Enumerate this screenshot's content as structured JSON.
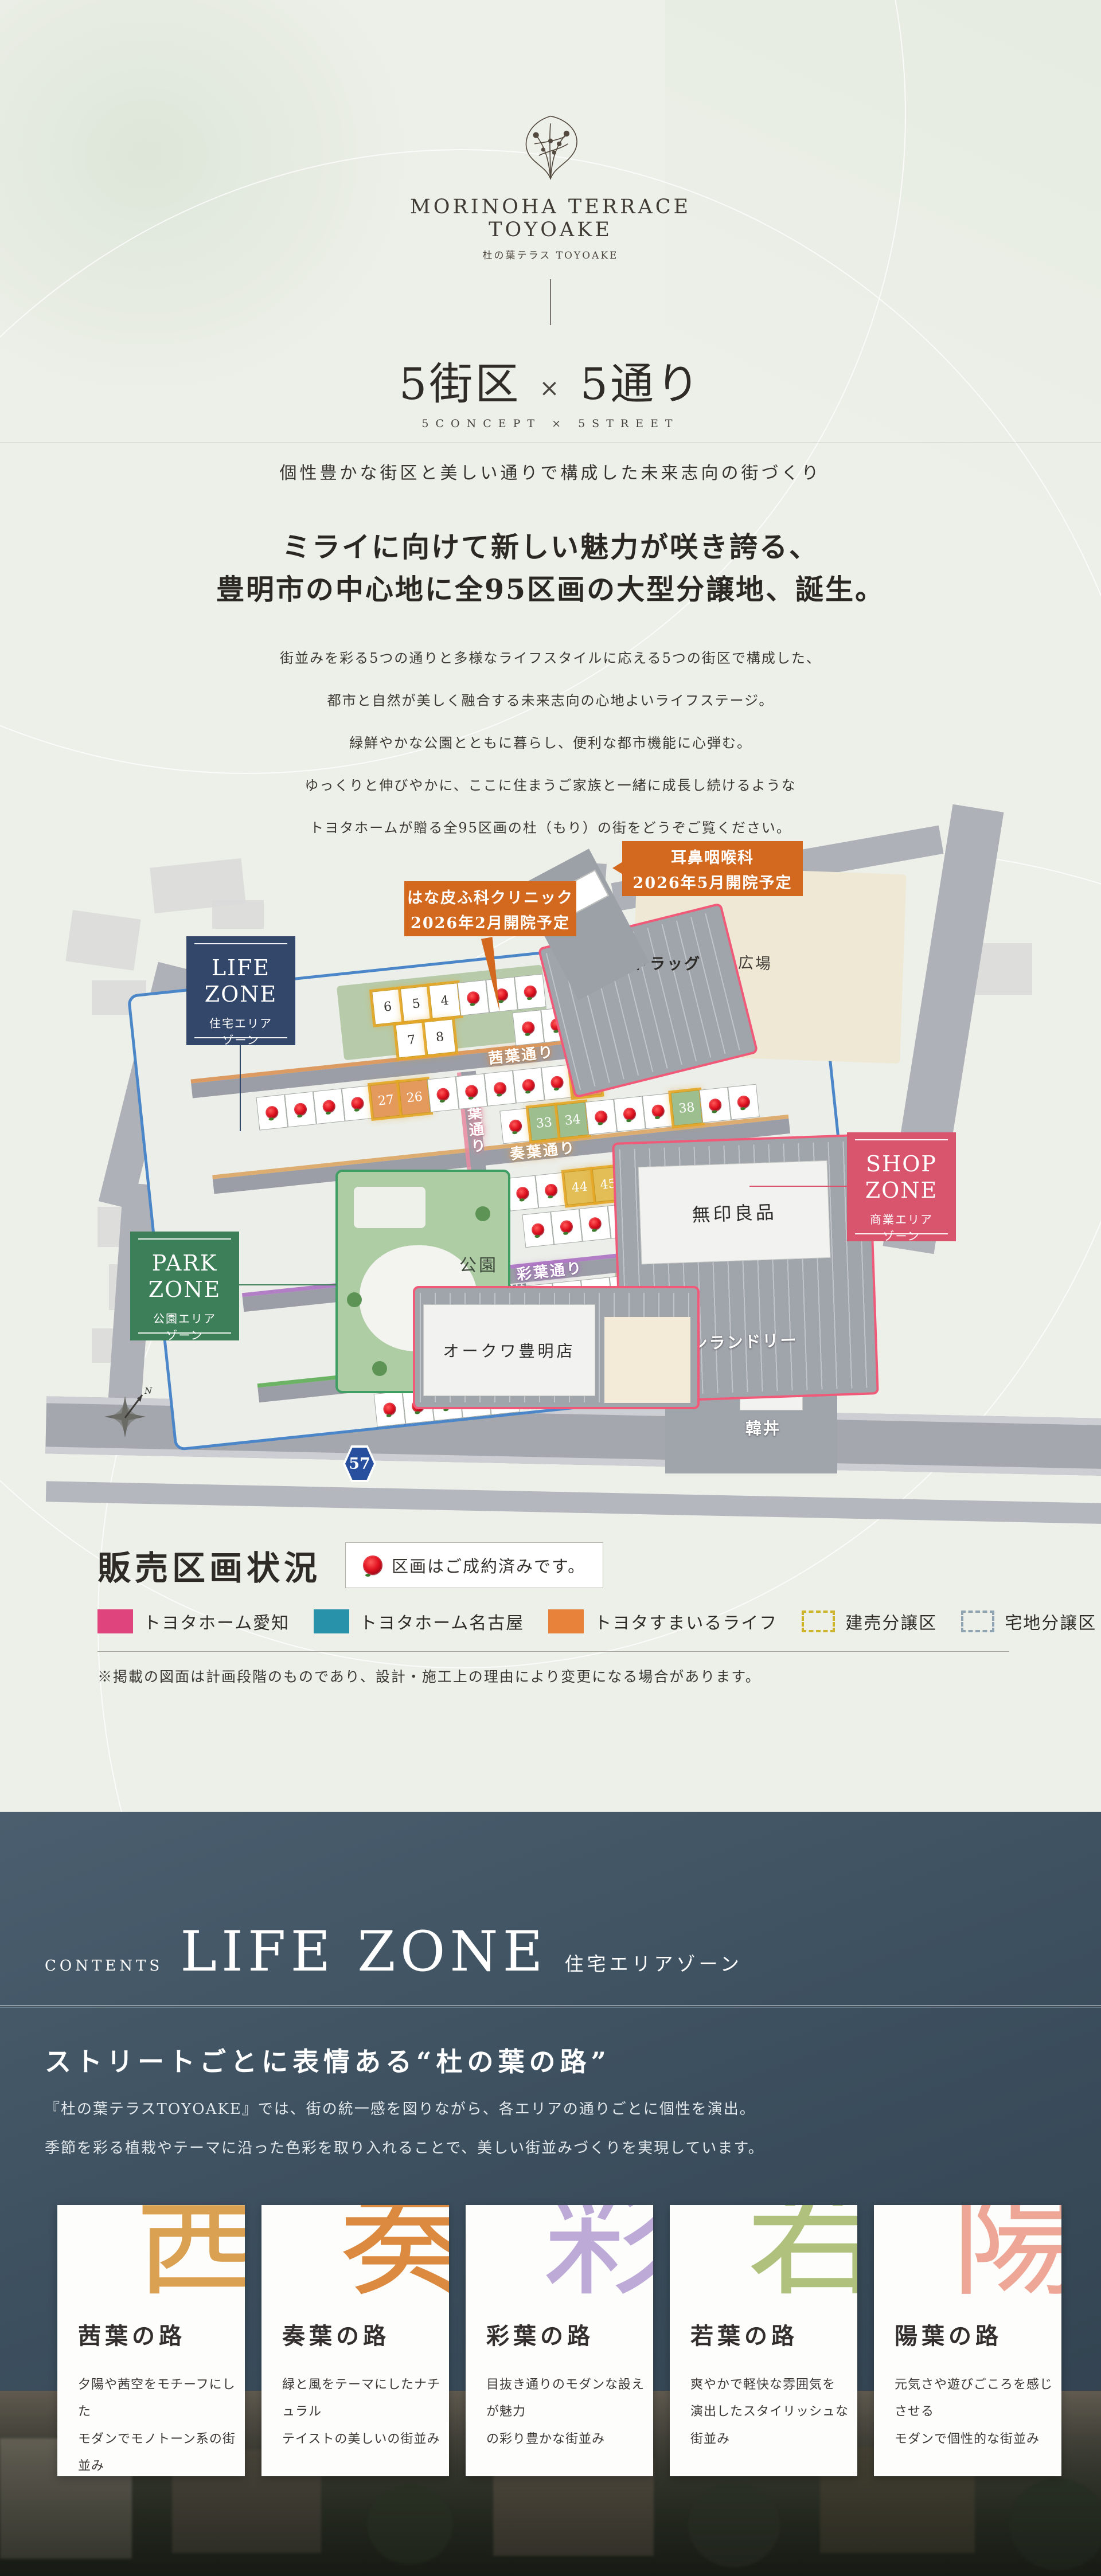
{
  "logo": {
    "brand_en_line1": "MORINOHA TERRACE",
    "brand_en_line2": "TOYOAKE",
    "brand_jp": "杜の葉テラス TOYOAKE"
  },
  "concept": {
    "title_left": "5街区",
    "title_x": "×",
    "title_right": "5通り",
    "subtitle": "5CONCEPT × 5STREET",
    "tagline": "個性豊かな街区と美しい通りで構成した未来志向の街づくり"
  },
  "intro": {
    "headline_line1": "ミライに向けて新しい魅力が咲き誇る、",
    "headline_line2": "豊明市の中心地に全95区画の大型分譲地、誕生。",
    "body_lines": [
      "街並みを彩る5つの通りと多様なライフスタイルに応える5つの街区で構成した、",
      "都市と自然が美しく融合する未来志向の心地よいライフステージ。",
      "緑鮮やかな公園とともに暮らし、便利な都市機能に心弾む。",
      "ゆっくりと伸びやかに、ここに住まうご家族と一緒に成長し続けるような",
      "トヨタホームが贈る全95区画の杜（もり）の街をどうぞご覧ください。"
    ]
  },
  "map": {
    "callout_color": "#d2691f",
    "callouts": [
      {
        "line1": "耳鼻咽喉科",
        "line2": "2026年5月開院予定"
      },
      {
        "line1": "はな皮ふ科クリニック",
        "line2": "2026年2月開院予定"
      }
    ],
    "zones": {
      "life": {
        "en1": "LIFE",
        "en2": "ZONE",
        "jp1": "住宅エリア",
        "jp2": "ゾーン",
        "color": "#33476b"
      },
      "park": {
        "en1": "PARK",
        "en2": "ZONE",
        "jp1": "公園エリア",
        "jp2": "ゾーン",
        "color": "#3d7f58"
      },
      "shop": {
        "en1": "SHOP",
        "en2": "ZONE",
        "jp1": "商業エリア",
        "jp2": "ゾーン",
        "color": "#d9556e"
      }
    },
    "streets": [
      {
        "name": "茜葉通り",
        "color": "#d98c4a"
      },
      {
        "name": "奏葉通り",
        "color": "#d9a05a"
      },
      {
        "name": "彩葉通り",
        "color": "#a86bbf"
      },
      {
        "name": "若葉通り",
        "color": "#56a84e"
      },
      {
        "name": "陽葉通り",
        "color": "#e88aa0"
      }
    ],
    "facilities": {
      "plaza": "宿ふれあい広場",
      "drugstore": "スギドラッグ",
      "muji": "無印良品",
      "laundry": "コインランドリー",
      "kandon": "韓丼",
      "okuwa": "オークワ豊明店",
      "park_label": "公園"
    },
    "route_shield": "57",
    "compass": "N",
    "lot_colors": {
      "g": "#9dbf90",
      "o": "#e59a5d",
      "y": "#e3bd55",
      "t": "#2e7f99"
    },
    "lot_bands": [
      {
        "cells": [
          {
            "n": "6"
          },
          {
            "n": "5"
          },
          {
            "n": "4"
          },
          {
            "r": 1
          },
          {
            "r": 1
          },
          {
            "r": 1
          }
        ]
      },
      {
        "cells": [
          {
            "n": "7"
          },
          {
            "n": "8"
          }
        ]
      },
      {
        "cells": [
          {
            "r": 1
          },
          {
            "r": 1
          },
          {
            "r": 1
          },
          {
            "r": 1
          },
          {
            "r": 1
          },
          {
            "r": 1
          }
        ]
      },
      {
        "cells": [
          {
            "r": 1
          },
          {
            "r": 1
          },
          {
            "r": 1
          },
          {
            "r": 1
          },
          {
            "n": "27",
            "c": "o"
          },
          {
            "n": "26",
            "c": "o"
          },
          {
            "r": 1
          },
          {
            "r": 1
          },
          {
            "r": 1
          },
          {
            "r": 1
          },
          {
            "r": 1
          },
          {
            "n": "41",
            "c": "o"
          }
        ]
      },
      {
        "cells": [
          {
            "r": 1
          },
          {
            "n": "33",
            "c": "g"
          },
          {
            "n": "34",
            "c": "g"
          },
          {
            "r": 1
          },
          {
            "r": 1
          },
          {
            "r": 1
          },
          {
            "n": "38",
            "c": "g"
          },
          {
            "r": 1
          },
          {
            "r": 1
          }
        ]
      },
      {
        "cells": [
          {
            "r": 1
          },
          {
            "r": 1
          },
          {
            "n": "44",
            "c": "y"
          },
          {
            "n": "45",
            "c": "y"
          },
          {
            "r": 1
          },
          {
            "r": 1
          },
          {
            "n": "48",
            "c": "g"
          },
          {
            "n": "49",
            "c": "o"
          },
          {
            "n": "50",
            "c": "g"
          },
          {
            "n": "51",
            "c": "o"
          },
          {
            "n": "52"
          }
        ]
      },
      {
        "cells": [
          {
            "r": 1
          },
          {
            "r": 1
          },
          {
            "r": 1
          },
          {
            "r": 1
          },
          {
            "r": 1
          },
          {
            "r": 1
          },
          {
            "n": "56",
            "c": "g"
          },
          {
            "n": "55",
            "c": "o"
          },
          {
            "r": 1
          }
        ]
      },
      {
        "cells": [
          {
            "r": 1
          },
          {
            "r": 1
          },
          {
            "r": 1
          },
          {
            "n": "64",
            "c": "o",
            "d": 1
          },
          {
            "r": 1
          },
          {
            "n": "66",
            "c": "t",
            "d": 1
          },
          {
            "r": 1
          },
          {
            "r": 1
          },
          {
            "r": 1
          },
          {
            "r": 1
          },
          {
            "n": "71"
          },
          {
            "n": "72",
            "c": "g"
          },
          {
            "n": "73",
            "c": "g"
          },
          {
            "n": "74"
          },
          {
            "n": "75"
          }
        ]
      },
      {
        "cells": [
          {
            "r": 1
          },
          {
            "r": 1
          },
          {
            "r": 1
          },
          {
            "n": "79"
          },
          {
            "n": "78"
          },
          {
            "n": "77"
          },
          {
            "r": 1
          }
        ]
      },
      {
        "cells": [
          {
            "r": 1
          },
          {
            "r": 1
          },
          {
            "r": 1
          },
          {
            "r": 1
          },
          {
            "r": 1
          }
        ]
      },
      {
        "cells": [
          {
            "n": "12",
            "c": "g"
          }
        ]
      },
      {
        "cells": [
          {
            "n": "18"
          },
          {
            "n": "19",
            "c": "o"
          },
          {
            "r": 1
          }
        ]
      },
      {
        "cells": [
          {
            "n": "17",
            "c": "g"
          },
          {
            "n": "16",
            "c": "g"
          },
          {
            "n": "15",
            "c": "o"
          },
          {
            "n": "14",
            "c": "o"
          }
        ]
      }
    ]
  },
  "legend": {
    "title": "販売区画状況",
    "sold_note": "区画はご成約済みです。",
    "items": [
      {
        "label": "トヨタホーム愛知",
        "color": "#e0447c",
        "type": "fill"
      },
      {
        "label": "トヨタホーム名古屋",
        "color": "#2892ab",
        "type": "fill"
      },
      {
        "label": "トヨタすまいるライフ",
        "color": "#e8813a",
        "type": "fill"
      },
      {
        "label": "建売分譲区",
        "color": "#cdb52b",
        "type": "dash"
      },
      {
        "label": "宅地分譲区",
        "color": "#8fa3b0",
        "type": "dash"
      }
    ],
    "note": "※掲載の図面は計画段階のものであり、設計・施工上の理由により変更になる場合があります。"
  },
  "contents_section": {
    "eyebrow": "CONTENTS",
    "title": "LIFE ZONE",
    "subtitle": "住宅エリアゾーン",
    "heading": "ストリートごとに表情ある“杜の葉の路”",
    "body_line1": "『杜の葉テラスTOYOAKE』では、街の統一感を図りながら、各エリアの通りごとに個性を演出。",
    "body_line2": "季節を彩る植栽やテーマに沿った色彩を取り入れることで、美しい街並みづくりを実現しています。",
    "cards": [
      {
        "kanji": "茜",
        "kanji_color": "#d99a45",
        "title": "茜葉の路",
        "desc_line1": "夕陽や茜空をモチーフにした",
        "desc_line2": "モダンでモノトーン系の街並み"
      },
      {
        "kanji": "奏",
        "kanji_color": "#d9812f",
        "title": "奏葉の路",
        "desc_line1": "緑と風をテーマにしたナチュラル",
        "desc_line2": "テイストの美しいの街並み"
      },
      {
        "kanji": "彩",
        "kanji_color": "#b9a4d4",
        "title": "彩葉の路",
        "desc_line1": "目抜き通りのモダンな設えが魅力",
        "desc_line2": "の彩り豊かな街並み"
      },
      {
        "kanji": "若",
        "kanji_color": "#a9bc72",
        "title": "若葉の路",
        "desc_line1": "爽やかで軽快な雰囲気を",
        "desc_line2": "演出したスタイリッシュな街並み"
      },
      {
        "kanji": "陽",
        "kanji_color": "#eda08e",
        "title": "陽葉の路",
        "desc_line1": "元気さや遊びごころを感じさせる",
        "desc_line2": "モダンで個性的な街並み"
      }
    ]
  }
}
